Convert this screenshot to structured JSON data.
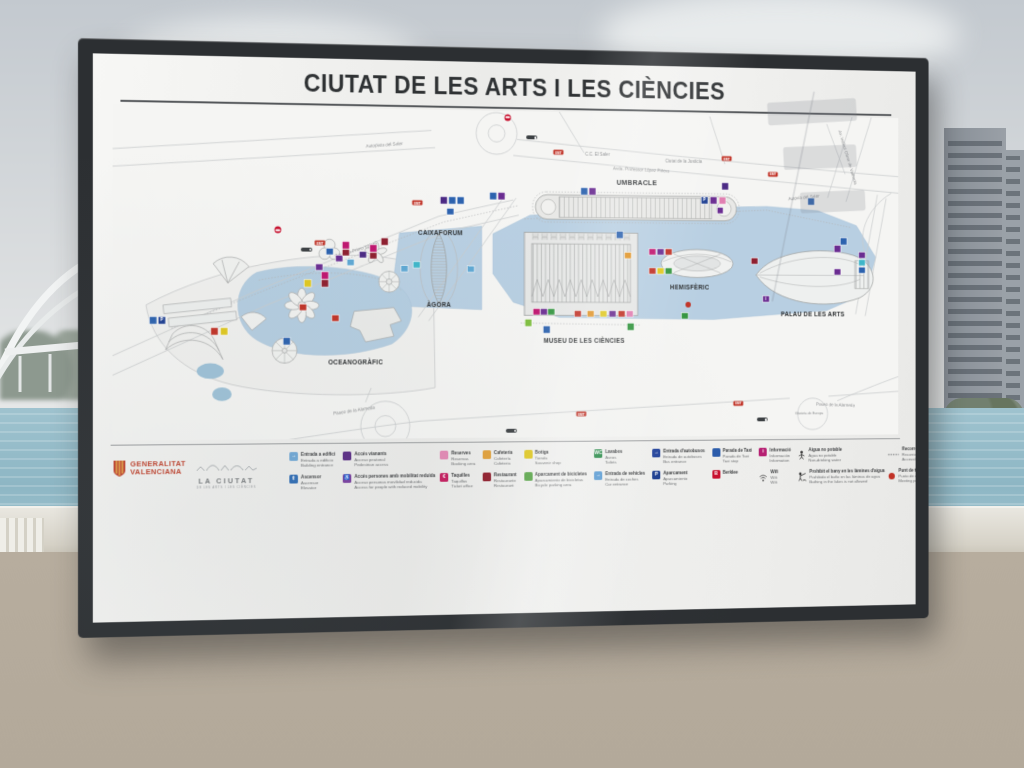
{
  "board": {
    "title": "CIUTAT DE LES ARTS I LES CIÈNCIES"
  },
  "map": {
    "venues": [
      {
        "label": "UMBRACLE"
      },
      {
        "label": "CAIXAFORUM"
      },
      {
        "label": "ÀGORA"
      },
      {
        "label": "HEMISFÈRIC"
      },
      {
        "label": "MUSEU DE LES CIÈNCIES"
      },
      {
        "label": "PALAU DE LES ARTS"
      },
      {
        "label": "OCEANOGRÀFIC"
      }
    ],
    "streets": [
      {
        "label": "Autopista del Saler"
      },
      {
        "label": "C.C. El Saler"
      },
      {
        "label": "Ciutat de la Justícia"
      },
      {
        "label": "Avda. Professor López Piñero"
      },
      {
        "label": "Autovia del Saler"
      },
      {
        "label": "Av. Institut Obrer de València"
      },
      {
        "label": "Eduardo Primo Yúfera"
      },
      {
        "label": "Paseo de la Alameda"
      },
      {
        "label": "Paseo de la Alameda"
      },
      {
        "label": "Glorieta de Europa"
      }
    ],
    "markers": [
      {
        "x": 170,
        "y": 128,
        "t": "metro"
      },
      {
        "x": 200,
        "y": 148,
        "t": "vb"
      },
      {
        "x": 214,
        "y": 141,
        "t": "emt"
      },
      {
        "x": 224,
        "y": 150,
        "c": "#2c62ae"
      },
      {
        "x": 234,
        "y": 157,
        "c": "#6a2c91"
      },
      {
        "x": 246,
        "y": 161,
        "c": "#5fa8d3"
      },
      {
        "x": 259,
        "y": 153,
        "c": "#4b2a84"
      },
      {
        "x": 270,
        "y": 146,
        "c": "#c0156f"
      },
      {
        "x": 270,
        "y": 154,
        "c": "#8e1f2f"
      },
      {
        "x": 282,
        "y": 139,
        "c": "#8e1f2f"
      },
      {
        "x": 213,
        "y": 166,
        "c": "#6a2c91"
      },
      {
        "x": 219,
        "y": 175,
        "c": "#c0156f"
      },
      {
        "x": 219,
        "y": 183,
        "c": "#8e1f2f"
      },
      {
        "x": 50,
        "y": 222,
        "c": "#1d3e91",
        "g": "P"
      },
      {
        "x": 41,
        "y": 222,
        "c": "#2c62ae"
      },
      {
        "x": 104,
        "y": 233,
        "c": "#c13226"
      },
      {
        "x": 114,
        "y": 233,
        "c": "#e0c81f"
      },
      {
        "x": 201,
        "y": 183,
        "c": "#e0c81f"
      },
      {
        "x": 196,
        "y": 208,
        "c": "#c13226"
      },
      {
        "x": 230,
        "y": 219,
        "c": "#c13226"
      },
      {
        "x": 179,
        "y": 243,
        "c": "#2c62ae"
      },
      {
        "x": 241,
        "y": 143,
        "c": "#c0156f"
      },
      {
        "x": 241,
        "y": 151,
        "c": "#8e1f2f"
      },
      {
        "x": 316,
        "y": 163,
        "c": "#3fb6c9"
      },
      {
        "x": 303,
        "y": 167,
        "c": "#5fa8d3"
      },
      {
        "x": 374,
        "y": 167,
        "c": "#5fa8d3"
      },
      {
        "x": 317,
        "y": 98,
        "t": "emt"
      },
      {
        "x": 414,
        "y": 7,
        "t": "metro"
      },
      {
        "x": 440,
        "y": 28,
        "t": "vb"
      },
      {
        "x": 469,
        "y": 43,
        "t": "emt"
      },
      {
        "x": 655,
        "y": 47,
        "t": "emt"
      },
      {
        "x": 707,
        "y": 63,
        "t": "emt"
      },
      {
        "x": 345,
        "y": 95,
        "c": "#4b2a84"
      },
      {
        "x": 354,
        "y": 95,
        "c": "#2c62ae"
      },
      {
        "x": 363,
        "y": 95,
        "c": "#2c62ae"
      },
      {
        "x": 352,
        "y": 107,
        "c": "#2c62ae"
      },
      {
        "x": 398,
        "y": 90,
        "c": "#2c62ae"
      },
      {
        "x": 407,
        "y": 90,
        "c": "#6a2c91"
      },
      {
        "x": 497,
        "y": 84,
        "c": "#2c62ae"
      },
      {
        "x": 506,
        "y": 84,
        "c": "#6a2c91"
      },
      {
        "x": 630,
        "y": 92,
        "c": "#1d3e91",
        "g": "P"
      },
      {
        "x": 640,
        "y": 92,
        "c": "#6a2c91"
      },
      {
        "x": 650,
        "y": 92,
        "c": "#e17fb1"
      },
      {
        "x": 648,
        "y": 103,
        "c": "#6a2c91"
      },
      {
        "x": 653,
        "y": 77,
        "c": "#4b2a84"
      },
      {
        "x": 445,
        "y": 212,
        "c": "#c0156f"
      },
      {
        "x": 453,
        "y": 212,
        "c": "#6a2c91"
      },
      {
        "x": 461,
        "y": 212,
        "c": "#33953f"
      },
      {
        "x": 490,
        "y": 214,
        "c": "#c13226"
      },
      {
        "x": 504,
        "y": 214,
        "c": "#e09427"
      },
      {
        "x": 518,
        "y": 214,
        "c": "#e0c81f"
      },
      {
        "x": 528,
        "y": 214,
        "c": "#6a2c91"
      },
      {
        "x": 538,
        "y": 214,
        "c": "#c13226"
      },
      {
        "x": 547,
        "y": 214,
        "c": "#e17fb1"
      },
      {
        "x": 436,
        "y": 224,
        "c": "#7fbf3f"
      },
      {
        "x": 456,
        "y": 231,
        "c": "#2c62ae"
      },
      {
        "x": 548,
        "y": 228,
        "c": "#33953f"
      },
      {
        "x": 545,
        "y": 152,
        "c": "#e09427"
      },
      {
        "x": 536,
        "y": 130,
        "c": "#2c62ae"
      },
      {
        "x": 572,
        "y": 148,
        "c": "#c0156f"
      },
      {
        "x": 581,
        "y": 148,
        "c": "#6a2c91"
      },
      {
        "x": 590,
        "y": 148,
        "c": "#c13226"
      },
      {
        "x": 572,
        "y": 168,
        "c": "#c13226"
      },
      {
        "x": 581,
        "y": 168,
        "c": "#e0c81f"
      },
      {
        "x": 590,
        "y": 168,
        "c": "#33953f"
      },
      {
        "x": 612,
        "y": 204,
        "t": "dotred"
      },
      {
        "x": 608,
        "y": 216,
        "c": "#33953f"
      },
      {
        "x": 686,
        "y": 157,
        "c": "#8e1f2f"
      },
      {
        "x": 699,
        "y": 198,
        "c": "#6a2c91",
        "g": "i"
      },
      {
        "x": 787,
        "y": 135,
        "c": "#2c62ae"
      },
      {
        "x": 780,
        "y": 143,
        "c": "#6a2c91"
      },
      {
        "x": 780,
        "y": 168,
        "c": "#6a2c91"
      },
      {
        "x": 808,
        "y": 150,
        "c": "#6a2c91"
      },
      {
        "x": 808,
        "y": 158,
        "c": "#3fb6c9"
      },
      {
        "x": 808,
        "y": 166,
        "c": "#2c62ae"
      },
      {
        "x": 750,
        "y": 92,
        "c": "#2c62ae"
      },
      {
        "x": 494,
        "y": 321,
        "t": "emt"
      },
      {
        "x": 668,
        "y": 310,
        "t": "emt"
      },
      {
        "x": 418,
        "y": 338,
        "t": "vb"
      },
      {
        "x": 695,
        "y": 328,
        "t": "vb"
      }
    ]
  },
  "legend": {
    "items": [
      {
        "icon": "building-entrance",
        "color": "#6fa8d6",
        "glyph": "→",
        "lines": [
          "Entrada a edifici",
          "Entrada a edificio",
          "Building entrance"
        ]
      },
      {
        "icon": "elevator",
        "color": "#2f6db5",
        "glyph": "⇕",
        "lines": [
          "Ascensor",
          "Ascensor",
          "Elevator"
        ]
      },
      {
        "icon": "pedestrian-access",
        "color": "#5b2d86",
        "glyph": "",
        "lines": [
          "Accés vianants",
          "Acceso peatonal",
          "Pedestrian access"
        ]
      },
      {
        "icon": "reduced-mobility-access",
        "color": "#7a3fa0",
        "glyph": "♿",
        "lines": [
          "Accés persones amb mobilitat reduïda",
          "Acceso personas movilidad reducida",
          "Access for people with reduced mobility"
        ]
      },
      {
        "icon": "reservations",
        "color": "#e38ab5",
        "glyph": "",
        "lines": [
          "Reserves",
          "Reservas",
          "Booking area"
        ]
      },
      {
        "icon": "ticket-office",
        "color": "#c51e5f",
        "glyph": "€",
        "lines": [
          "Taquilles",
          "Taquillas",
          "Ticket office"
        ]
      },
      {
        "icon": "cafeteria",
        "color": "#e2a23c",
        "glyph": "",
        "lines": [
          "Cafeteria",
          "Cafetería",
          "Cafeteria"
        ]
      },
      {
        "icon": "restaurant",
        "color": "#92212f",
        "glyph": "",
        "lines": [
          "Restaurant",
          "Restaurante",
          "Restaurant"
        ]
      },
      {
        "icon": "shop",
        "color": "#e0c81f",
        "glyph": "",
        "lines": [
          "Botiga",
          "Tienda",
          "Souvenir shop"
        ]
      },
      {
        "icon": "bicycle-parking",
        "color": "#58a546",
        "glyph": "",
        "lines": [
          "Aparcament de bicicletes",
          "Aparcamiento de bicicletas",
          "Bicycle parking area"
        ]
      },
      {
        "icon": "toilets",
        "color": "#2f8f4e",
        "glyph": "WC",
        "lines": [
          "Lavabos",
          "Aseos",
          "Toilets"
        ]
      },
      {
        "icon": "car-entrance",
        "color": "#5f9fd6",
        "glyph": "→",
        "lines": [
          "Entrada de vehicles",
          "Entrada de coches",
          "Car entrance"
        ]
      },
      {
        "icon": "bus-entrance",
        "color": "#27479e",
        "glyph": "→",
        "lines": [
          "Entrada d'autobusos",
          "Entrada de autobuses",
          "Bus entrance"
        ]
      },
      {
        "icon": "parking",
        "color": "#1d3e91",
        "glyph": "P",
        "lines": [
          "Aparcament",
          "Aparcamiento",
          "Parking"
        ]
      },
      {
        "icon": "taxi-stop",
        "color": "#2b5cab",
        "glyph": "",
        "lines": [
          "Parada de Taxi",
          "Parada de Taxi",
          "Taxi stop"
        ]
      },
      {
        "icon": "berklee-logo",
        "color": "#c8102e",
        "glyph": "B",
        "lines": [
          "Berklee"
        ]
      },
      {
        "icon": "information",
        "color": "#b61f72",
        "glyph": "i",
        "lines": [
          "Informació",
          "Información",
          "Information"
        ]
      },
      {
        "icon": "wifi",
        "special": "wifi",
        "lines": [
          "Wifi",
          "Wifi",
          "Wifi"
        ]
      },
      {
        "icon": "no-drinking-water",
        "special": "nodrink",
        "lines": [
          "Aigua no potable",
          "Agua no potable",
          "Non-drinking water"
        ]
      },
      {
        "icon": "no-bathing",
        "special": "nobath",
        "lines": [
          "Prohibit el bany en les làmines d'aigua",
          "Prohibido el baño en las láminas de agua",
          "Bathing in the lakes is not allowed"
        ]
      },
      {
        "icon": "accessible-routes",
        "special": "dotted",
        "lines": [
          "Recorreguts accessibles",
          "Recorridos accesibles",
          "Accessible routes"
        ]
      },
      {
        "icon": "meeting-point",
        "special": "redcircle",
        "lines": [
          "Punt de trobada",
          "Punto de encuentro",
          "Meeting point"
        ]
      }
    ],
    "transport": {
      "valenbisi": "valenbisi",
      "emt_label": "EMT",
      "metro_lines": [
        "Metro València Línia 10",
        "Metro Valencia Línea 10",
        "Metro Valencia Line 10"
      ]
    }
  },
  "footer_logos": {
    "generalitat": {
      "line1": "GENERALITAT",
      "line2": "VALENCIANA"
    },
    "la_ciutat": {
      "name": "LA CIUTAT",
      "tagline": "DE LES ARTS I LES CIÈNCIES"
    }
  }
}
